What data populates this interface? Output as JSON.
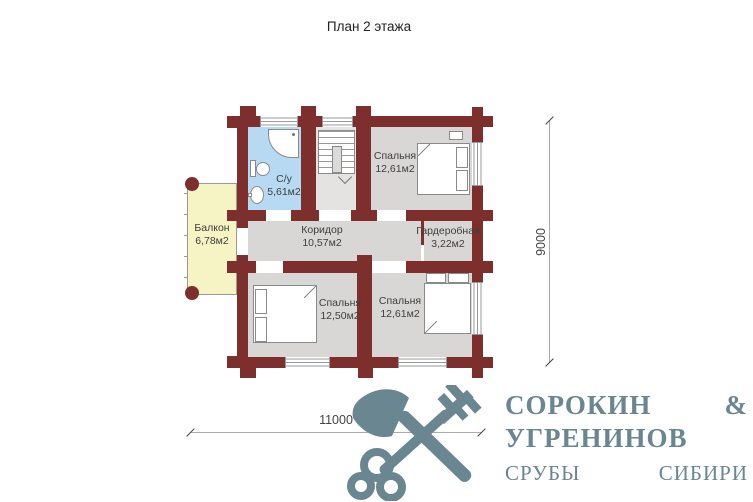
{
  "title": "План 2 этажа",
  "rooms": {
    "bathroom": {
      "name": "С/у",
      "area": "5,61м2"
    },
    "bedroom_top": {
      "name": "Спальня",
      "area": "12,61м2"
    },
    "balcony": {
      "name": "Балкон",
      "area": "6,78м2"
    },
    "corridor": {
      "name": "Коридор",
      "area": "10,57м2"
    },
    "wardrobe": {
      "name": "Гардеробная",
      "area": "3,22м2"
    },
    "bedroom_bottom_left": {
      "name": "Спальня",
      "area": "12,50м2"
    },
    "bedroom_bottom_right": {
      "name": "Спальня",
      "area": "12,61м2"
    }
  },
  "dimensions": {
    "vertical": "9000",
    "horizontal": "11000"
  },
  "logo": {
    "line1": "СОРОКИН &",
    "line2": "УГРЕНИНОВ",
    "line3": "СРУБЫ СИБИРИ"
  },
  "colors": {
    "wall": "#7c2f2c",
    "bathroom_floor": "#b7d9f1",
    "balcony_floor": "#f6f3c5",
    "room_floor": "#d8d7d5",
    "logo": "#6a8691"
  }
}
